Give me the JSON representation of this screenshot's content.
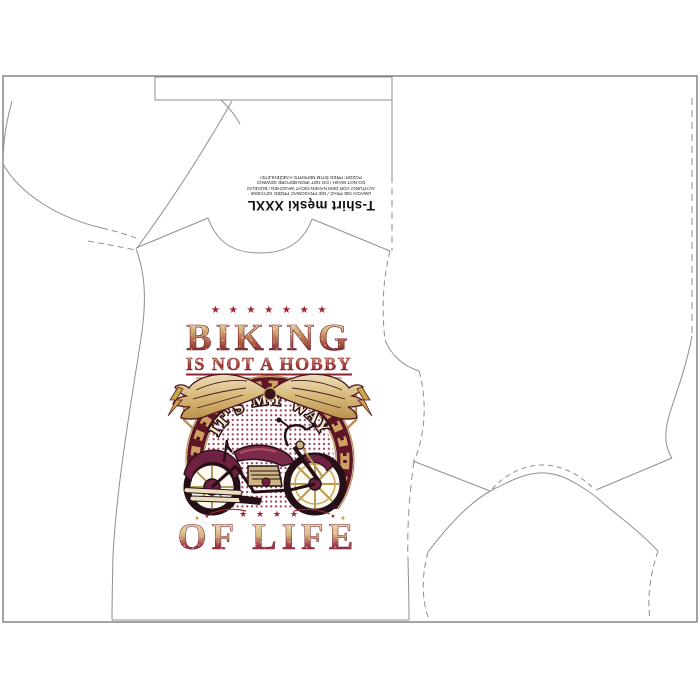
{
  "sheet": {
    "size_label": "T-shirt męski XXXL",
    "care_lines": [
      "UWAGA! NIE PRAĆ / NIE PRASOWAĆ PRZED SZYCIEM!",
      "ACHTUNG! VOR DEM NÄHEN NICHT WASCHEN / BÜGELN!",
      "DO NOT WASH / DO NOT IRON BEFORE SEWING!",
      "POZOR: PŘED ŠITÍM NEPERTE A NEŽEHLETE!"
    ]
  },
  "print": {
    "stars_top": "★ ★ ★ ★ ★ ★ ★",
    "title": "BIKING",
    "subtitle": "IS NOT A HOBBY",
    "stars_small": "★ ★ ★",
    "arc_text": "IT'S MY WAY",
    "stars_bottom": "★ ★ ★ ★",
    "title_bottom": "OF LIFE",
    "colors": {
      "cream": "#efe3c0",
      "gold": "#c9a55e",
      "red": "#9e2732",
      "maroon": "#5e1626",
      "plum": "#7c2a4a",
      "outline_dark": "#2a1216",
      "halftone": "#8c2440"
    }
  },
  "pattern": {
    "line_color": "#8f8f8f"
  }
}
